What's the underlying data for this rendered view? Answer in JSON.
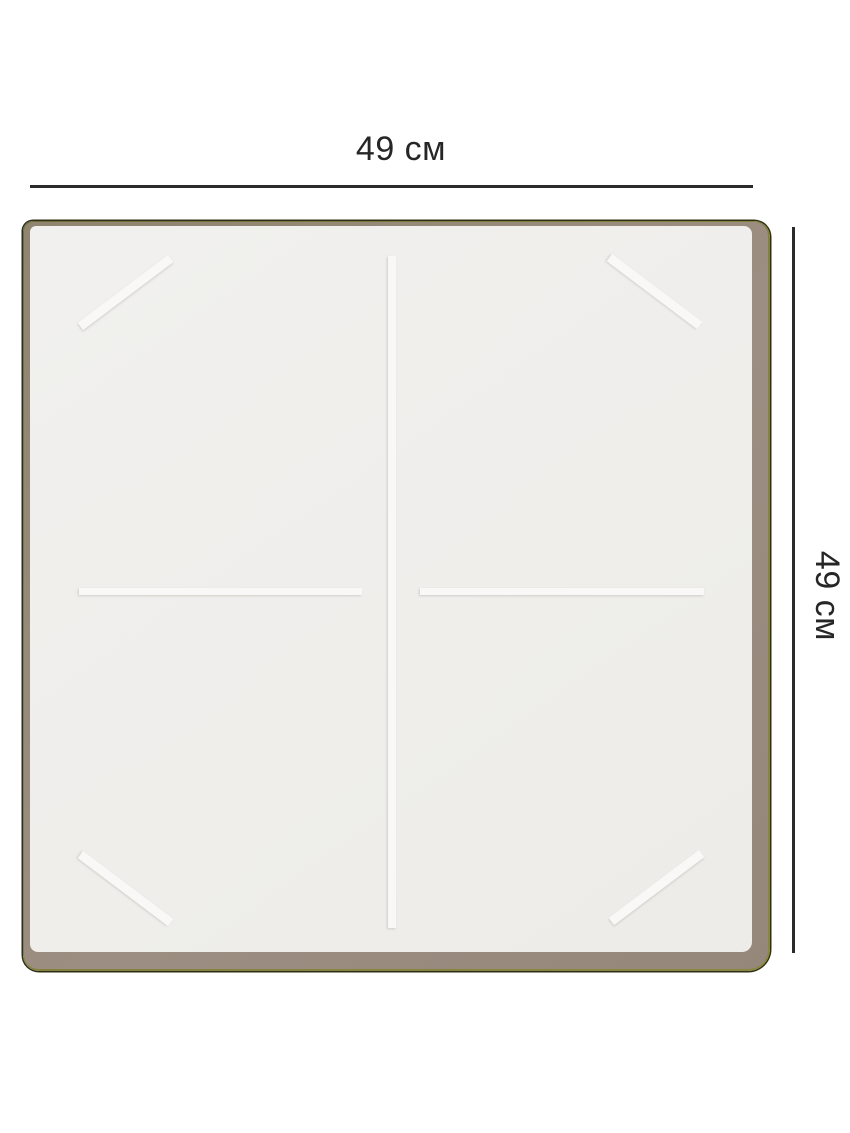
{
  "diagram": {
    "subject": "induction-hob-top-view",
    "dimension_top": {
      "label": "49 см"
    },
    "dimension_right": {
      "label": "49 см"
    },
    "markings": [
      "center-vertical-divider",
      "left-zone-horizontal",
      "right-zone-horizontal",
      "corner-diagonal-top-left",
      "corner-diagonal-top-right",
      "corner-diagonal-bottom-left",
      "corner-diagonal-bottom-right"
    ],
    "colors": {
      "background": "#ffffff",
      "dimension_line": "#2b2b2b",
      "label_text": "#262626",
      "panel_surface": "#f0efec",
      "panel_frame": "#9c8e82",
      "panel_edge_olive": "#83803f",
      "panel_outline": "#2f2f18",
      "marking": "#f9f8f6"
    }
  }
}
